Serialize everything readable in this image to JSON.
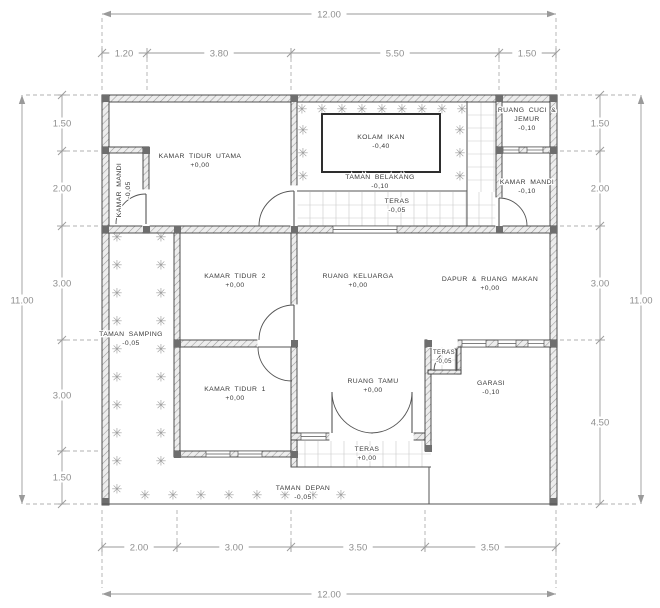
{
  "drawing": {
    "type": "architectural-floor-plan",
    "overall_width_label": "12.00",
    "overall_height_label": "11.00"
  },
  "colors": {
    "ink": "#3c3c3c",
    "wall_fill": "#ededed",
    "wall_hatch": "#9a9a9a",
    "thin_line": "#555555",
    "tile": "#c9c9c9",
    "plant": "#9e9e9e",
    "label_text": "#3a3a3a",
    "dim_text": "#8f8f8f",
    "dim_line": "#9a9a9a",
    "dash_line": "#b0b0b0",
    "column": "#6e6e6e",
    "pond_border": "#2e2e2e"
  },
  "rooms": [
    {
      "id": "kamar-tidur-utama",
      "lines": [
        "KAMAR TIDUR UTAMA"
      ],
      "level": "+0,00",
      "x": 200,
      "y": 158
    },
    {
      "id": "kamar-mandi-1",
      "lines": [
        "KAMAR MANDI"
      ],
      "level": "-0,05",
      "x": 121,
      "y": 190,
      "rot": -90
    },
    {
      "id": "kolam-ikan",
      "lines": [
        "KOLAM IKAN"
      ],
      "level": "-0,40",
      "x": 381,
      "y": 139
    },
    {
      "id": "taman-belakang",
      "lines": [
        "TAMAN BELAKANG"
      ],
      "level": "-0,10",
      "x": 380,
      "y": 179
    },
    {
      "id": "teras-belakang",
      "lines": [
        "TERAS"
      ],
      "level": "-0,05",
      "x": 397,
      "y": 203
    },
    {
      "id": "ruang-cuci-jemur",
      "lines": [
        "RUANG CUCI &",
        "JEMUR"
      ],
      "level": "-0,10",
      "x": 527,
      "y": 112
    },
    {
      "id": "kamar-mandi-2",
      "lines": [
        "KAMAR MANDI"
      ],
      "level": "-0,10",
      "x": 527,
      "y": 184
    },
    {
      "id": "kamar-tidur-2",
      "lines": [
        "KAMAR TIDUR 2"
      ],
      "level": "+0,00",
      "x": 235,
      "y": 278
    },
    {
      "id": "ruang-keluarga",
      "lines": [
        "RUANG KELUARGA"
      ],
      "level": "+0,00",
      "x": 358,
      "y": 278
    },
    {
      "id": "dapur-ruang-makan",
      "lines": [
        "DAPUR & RUANG MAKAN"
      ],
      "level": "+0,00",
      "x": 490,
      "y": 281
    },
    {
      "id": "taman-samping",
      "lines": [
        "TAMAN SAMPING"
      ],
      "level": "-0,05",
      "x": 131,
      "y": 336
    },
    {
      "id": "kamar-tidur-1",
      "lines": [
        "KAMAR TIDUR 1"
      ],
      "level": "+0,00",
      "x": 235,
      "y": 391
    },
    {
      "id": "ruang-tamu",
      "lines": [
        "RUANG TAMU"
      ],
      "level": "+0,00",
      "x": 373,
      "y": 383
    },
    {
      "id": "teras-depan",
      "lines": [
        "TERAS"
      ],
      "level": "+0,00",
      "x": 367,
      "y": 451
    },
    {
      "id": "teras-samping",
      "lines": [
        "TERAS"
      ],
      "level": "-0,05",
      "x": 444,
      "y": 354,
      "size": 6
    },
    {
      "id": "garasi",
      "lines": [
        "GARASI"
      ],
      "level": "-0,10",
      "x": 491,
      "y": 385
    },
    {
      "id": "taman-depan",
      "lines": [
        "TAMAN DEPAN"
      ],
      "level": "-0,05",
      "x": 303,
      "y": 490
    }
  ],
  "geometry": {
    "walls": [
      [
        102,
        95,
        455,
        7
      ],
      [
        102,
        95,
        7,
        410
      ],
      [
        550,
        95,
        7,
        410
      ],
      [
        102,
        147,
        47,
        6
      ],
      [
        143,
        147,
        6,
        86
      ],
      [
        102,
        226,
        455,
        7
      ],
      [
        291,
        95,
        6,
        91
      ],
      [
        291,
        233,
        6,
        72
      ],
      [
        291,
        347,
        6,
        109
      ],
      [
        174,
        233,
        6,
        223
      ],
      [
        174,
        340,
        123,
        7
      ],
      [
        174,
        451,
        123,
        6
      ],
      [
        291,
        433,
        140,
        7
      ],
      [
        291,
        440,
        6,
        27
      ],
      [
        425,
        340,
        6,
        111
      ],
      [
        425,
        340,
        132,
        7
      ],
      [
        496,
        95,
        6,
        131
      ],
      [
        496,
        147,
        61,
        6
      ],
      [
        457,
        347,
        4,
        27
      ],
      [
        428,
        370,
        33,
        4
      ]
    ],
    "gaps": [
      [
        291,
        186,
        6,
        40
      ],
      [
        291,
        305,
        6,
        35
      ],
      [
        258,
        340,
        33,
        7
      ],
      [
        496,
        198,
        6,
        28
      ],
      [
        330,
        433,
        83,
        7
      ],
      [
        143,
        190,
        6,
        36
      ],
      [
        428,
        340,
        29,
        7
      ]
    ],
    "windows": [
      [
        333,
        226,
        64,
        7
      ],
      [
        301,
        433,
        25,
        7
      ],
      [
        206,
        451,
        24,
        6
      ],
      [
        238,
        451,
        24,
        6
      ],
      [
        462,
        340,
        24,
        7
      ],
      [
        498,
        340,
        18,
        7
      ],
      [
        528,
        340,
        16,
        7
      ],
      [
        503,
        147,
        16,
        6
      ],
      [
        527,
        147,
        16,
        6
      ]
    ],
    "columns": [
      [
        102,
        95
      ],
      [
        291,
        95
      ],
      [
        496,
        95
      ],
      [
        550,
        95
      ],
      [
        102,
        147
      ],
      [
        143,
        147
      ],
      [
        496,
        147
      ],
      [
        550,
        147
      ],
      [
        102,
        226
      ],
      [
        143,
        226
      ],
      [
        174,
        226
      ],
      [
        291,
        226
      ],
      [
        496,
        226
      ],
      [
        550,
        226
      ],
      [
        174,
        340
      ],
      [
        291,
        340
      ],
      [
        425,
        340
      ],
      [
        550,
        340
      ],
      [
        174,
        451
      ],
      [
        291,
        451
      ],
      [
        425,
        445
      ],
      [
        102,
        498
      ],
      [
        550,
        498
      ]
    ],
    "tiles": [
      [
        468,
        102,
        28,
        124
      ],
      [
        297,
        192,
        199,
        34
      ],
      [
        292,
        441,
        139,
        26
      ],
      [
        429,
        347,
        28,
        23
      ]
    ],
    "tile_grid": 13,
    "pond": [
      322,
      114,
      118,
      58
    ],
    "lines": [
      [
        467,
        101,
        467,
        192
      ],
      [
        297,
        191,
        467,
        191
      ],
      [
        467,
        192,
        467,
        226
      ],
      [
        291,
        467,
        431,
        467
      ],
      [
        429,
        467,
        429,
        504
      ],
      [
        102,
        504,
        557,
        504
      ]
    ],
    "doors": [
      {
        "d": "M294 191A35 35 0 0 0 259 226",
        "leaf": [
          294,
          191,
          294,
          226
        ]
      },
      {
        "d": "M294 305A35 35 0 0 0 259 340",
        "leaf": [
          294,
          305,
          294,
          340
        ]
      },
      {
        "d": "M258 347A34 34 0 0 0 292 381",
        "leaf": [
          258,
          347,
          292,
          347
        ]
      },
      {
        "d": "M146 194A30 30 0 0 0 116 224",
        "leaf": [
          146,
          194,
          146,
          224
        ]
      },
      {
        "d": "M499 198A28 28 0 0 1 527 226",
        "leaf": [
          499,
          198,
          499,
          226
        ]
      },
      {
        "d": "M456 349A22 22 0 0 0 434 371",
        "leaf": [
          456,
          349,
          456,
          371
        ]
      },
      {
        "d": "M332 392A41 41 0 0 0 373 433",
        "leaf": [
          332,
          392,
          332,
          433
        ]
      },
      {
        "d": "M412 392A41 41 0 0 1 371 433",
        "leaf": [
          412,
          392,
          412,
          433
        ]
      }
    ],
    "plants": [
      [
        302,
        109
      ],
      [
        322,
        109
      ],
      [
        342,
        109
      ],
      [
        362,
        109
      ],
      [
        382,
        109
      ],
      [
        402,
        109
      ],
      [
        422,
        109
      ],
      [
        442,
        109
      ],
      [
        462,
        109
      ],
      [
        303,
        130
      ],
      [
        303,
        153
      ],
      [
        303,
        176
      ],
      [
        460,
        130
      ],
      [
        460,
        153
      ],
      [
        460,
        176
      ],
      [
        117,
        237
      ],
      [
        117,
        265
      ],
      [
        117,
        293
      ],
      [
        117,
        321
      ],
      [
        117,
        349
      ],
      [
        117,
        377
      ],
      [
        117,
        405
      ],
      [
        117,
        433
      ],
      [
        117,
        461
      ],
      [
        117,
        489
      ],
      [
        161,
        237
      ],
      [
        161,
        265
      ],
      [
        161,
        293
      ],
      [
        161,
        321
      ],
      [
        161,
        349
      ],
      [
        161,
        377
      ],
      [
        161,
        405
      ],
      [
        161,
        433
      ],
      [
        161,
        461
      ],
      [
        145,
        495
      ],
      [
        173,
        495
      ],
      [
        201,
        495
      ],
      [
        229,
        495
      ],
      [
        257,
        495
      ],
      [
        285,
        495
      ],
      [
        313,
        495
      ],
      [
        341,
        495
      ]
    ]
  },
  "dims": {
    "top": {
      "overall": {
        "v": "12.00",
        "y": 14,
        "x1": 102,
        "x2": 556,
        "lx": 329
      },
      "seg": {
        "y": 53,
        "x1": 102,
        "x2": 556,
        "ticks": [
          102,
          147,
          291,
          499,
          556
        ],
        "labels": [
          {
            "v": "1.20",
            "x": 124
          },
          {
            "v": "3.80",
            "x": 219
          },
          {
            "v": "5.50",
            "x": 395
          },
          {
            "v": "1.50",
            "x": 527
          }
        ]
      },
      "ext": {
        "y1": 58,
        "y2": 90,
        "xs": [
          102,
          147,
          291,
          499,
          556
        ]
      },
      "ext2": {
        "y1": 18,
        "y2": 48,
        "xs": [
          102,
          556
        ]
      }
    },
    "bottom": {
      "overall": {
        "v": "12.00",
        "y": 594,
        "x1": 102,
        "x2": 556,
        "lx": 329
      },
      "seg": {
        "y": 547,
        "x1": 102,
        "x2": 556,
        "ticks": [
          102,
          177,
          291,
          425,
          556
        ],
        "labels": [
          {
            "v": "2.00",
            "x": 139
          },
          {
            "v": "3.00",
            "x": 234
          },
          {
            "v": "3.50",
            "x": 358
          },
          {
            "v": "3.50",
            "x": 490
          }
        ]
      },
      "ext": {
        "y1": 510,
        "y2": 542,
        "xs": [
          102,
          177,
          291,
          425,
          556
        ]
      },
      "ext2": {
        "y1": 552,
        "y2": 588,
        "xs": [
          102,
          556
        ]
      }
    },
    "left": {
      "overall": {
        "v": "11.00",
        "x": 22,
        "y1": 95,
        "y2": 504,
        "ly": 300
      },
      "seg": {
        "x": 62,
        "y1": 95,
        "y2": 504,
        "ticks": [
          95,
          151,
          226,
          340,
          451,
          504
        ],
        "labels": [
          {
            "v": "1.50",
            "y": 123
          },
          {
            "v": "2.00",
            "y": 188
          },
          {
            "v": "3.00",
            "y": 283
          },
          {
            "v": "3.00",
            "y": 395
          },
          {
            "v": "1.50",
            "y": 477
          }
        ]
      },
      "ext": {
        "x1": 66,
        "x2": 98,
        "ys": [
          95,
          151,
          226,
          340,
          451,
          504
        ]
      },
      "ext2": {
        "x1": 26,
        "x2": 58,
        "ys": [
          95,
          504
        ]
      }
    },
    "right": {
      "overall": {
        "v": "11.00",
        "x": 641,
        "y1": 95,
        "y2": 504,
        "ly": 300
      },
      "seg": {
        "x": 600,
        "y1": 95,
        "y2": 504,
        "ticks": [
          95,
          151,
          226,
          340,
          504
        ],
        "labels": [
          {
            "v": "1.50",
            "y": 123
          },
          {
            "v": "2.00",
            "y": 188
          },
          {
            "v": "3.00",
            "y": 283
          },
          {
            "v": "4.50",
            "y": 422
          }
        ]
      },
      "ext": {
        "x1": 560,
        "x2": 596,
        "ys": [
          95,
          151,
          226,
          340,
          504
        ]
      },
      "ext2": {
        "x1": 604,
        "x2": 637,
        "ys": [
          95,
          504
        ]
      }
    }
  }
}
